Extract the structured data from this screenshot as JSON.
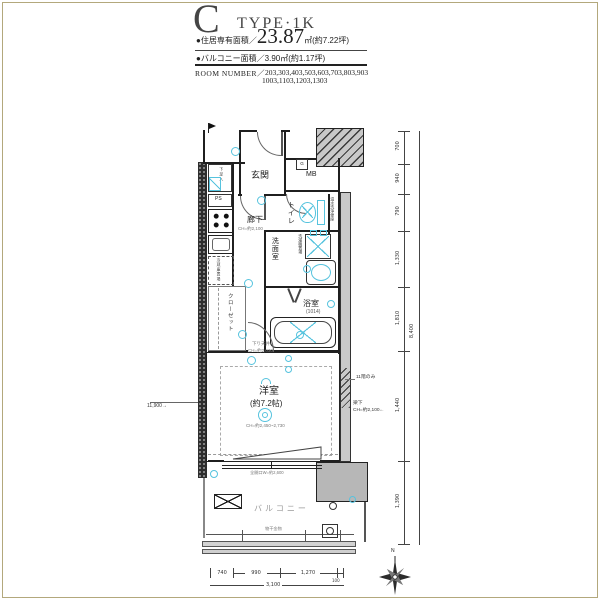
{
  "header": {
    "type_letter": "C",
    "type_name": "TYPE·1K",
    "area_label": "●住居専有面積／",
    "area_value": "23.87",
    "area_unit": "㎡(約7.22坪)",
    "balcony_label": "●バルコニー面積／",
    "balcony_value": "3.90㎡(約1.17坪)",
    "room_number_label": "ROOM NUMBER／",
    "room_numbers_1": "203,303,403,503,603,703,803,903",
    "room_numbers_2": "1003,1103,1203,1303"
  },
  "rooms": {
    "entrance": "玄関",
    "meter_box": "MB",
    "gas_meter": "G",
    "toilet": "トイレ",
    "toilet_note": "温水洗浄便座",
    "washroom": "洗面室",
    "washer_space": "洗濯機置場",
    "bathroom": "浴室",
    "bathroom_size": "(1014)",
    "corridor": "廊下",
    "corridor_ch": "CH=約2,100",
    "closet": "クローゼット",
    "shoes_box": "下足入",
    "pipe_space": "PS",
    "fridge_space": "冷蔵庫置場",
    "main_room": "洋室",
    "main_room_size": "(約7.2帖)",
    "main_room_ch": "CH=約2,450~2,730",
    "balcony": "バルコニー"
  },
  "notes": {
    "drop_ceiling_1": "下り天井",
    "drop_ceiling_2": "CH=約2,030",
    "beam_floor": "11階のみ",
    "beam_under_1": "梁下",
    "beam_under_2": "CH=約2,100←",
    "laundry_fitting": "物干金物",
    "window_note": "全開口W=約2,600",
    "left_distance": "11,900→",
    "compass_north": "N"
  },
  "dimensions": {
    "bottom_segments": [
      "740",
      "990",
      "1,270",
      "100"
    ],
    "bottom_total": "3,100",
    "right_segments": [
      "700",
      "940",
      "790",
      "1,330",
      "1,810",
      "1,440",
      "1,390"
    ],
    "right_total": "8,400"
  },
  "colors": {
    "accent_cyan": "#56c3de",
    "wall_dark": "#1f1f1f",
    "concrete_gray": "#b7b7b7",
    "frame_gold": "#b3a87c"
  }
}
